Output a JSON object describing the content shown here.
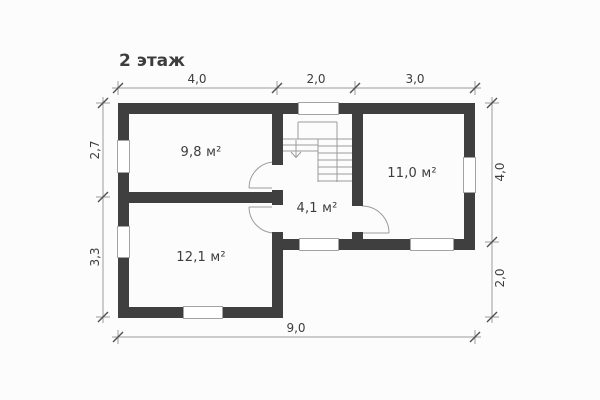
{
  "title": "2 этаж",
  "colors": {
    "wall": "#3f3f3f",
    "line": "#9b9b9b",
    "tick": "#4f4f4f",
    "text": "#3d3d3d",
    "background": "#fcfcfc"
  },
  "rooms": {
    "room_9_8": "9,8 м²",
    "room_12_1": "12,1 м²",
    "room_4_1": "4,1 м²",
    "room_11_0": "11,0 м²"
  },
  "dimensions": {
    "top": [
      "4,0",
      "2,0",
      "3,0"
    ],
    "left": [
      "2,7",
      "3,3"
    ],
    "right": [
      "4,0",
      "2,0"
    ],
    "bottom": [
      "9,0"
    ]
  }
}
